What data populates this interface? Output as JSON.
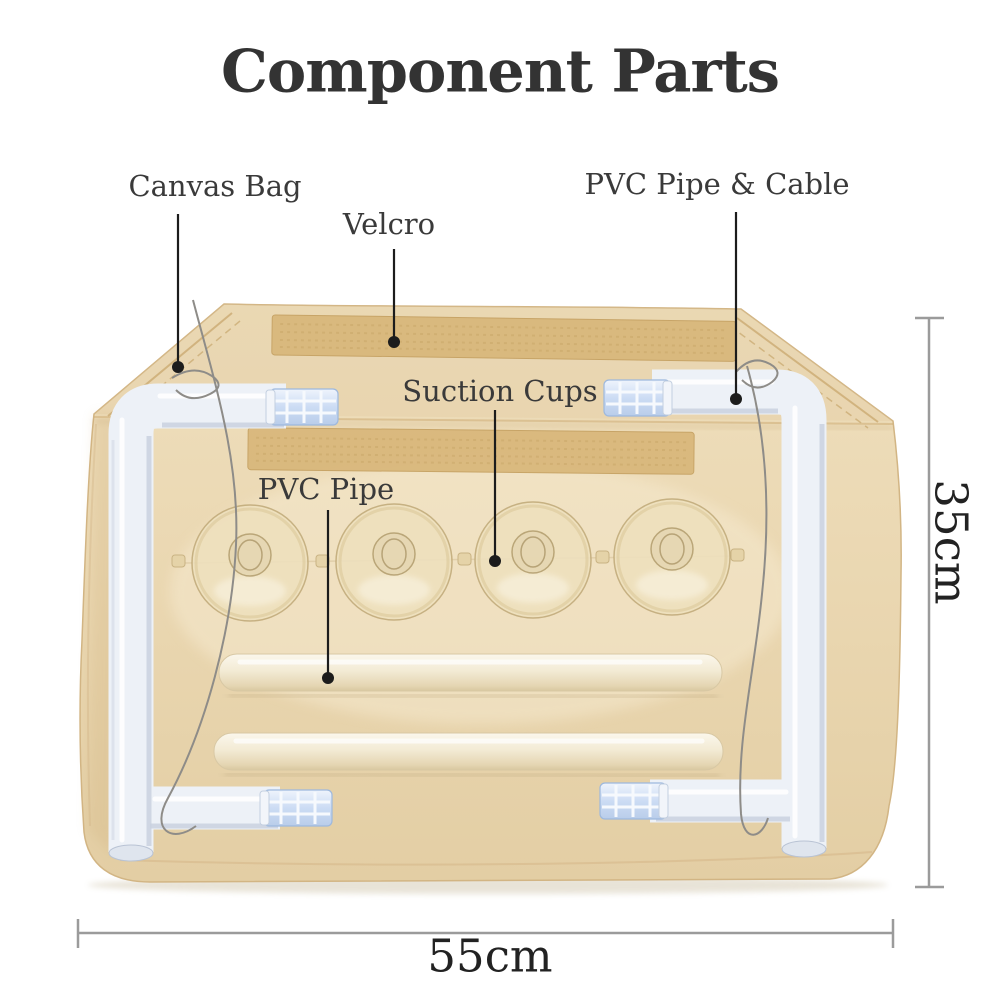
{
  "title": "Component Parts",
  "labels": {
    "canvas_bag": "Canvas Bag",
    "velcro": "Velcro",
    "pvc_pipe_cable": "PVC Pipe & Cable",
    "suction_cups": "Suction Cups",
    "pvc_pipe": "PVC Pipe"
  },
  "dimensions": {
    "width_label": "55cm",
    "height_label": "35cm"
  },
  "colors": {
    "canvas_bag": "#e9d6b1",
    "velcro_strip": "#d8b87c",
    "pvc_pipe_white": "#eef1f7",
    "pvc_pipe_cream": "#f3ebd5",
    "connector_blue": "#ccdcf4",
    "label_text": "#3a3a3a",
    "title_text": "#333333",
    "dimension_line": "#9b9b9b",
    "leader_line": "#1c1c1c"
  }
}
